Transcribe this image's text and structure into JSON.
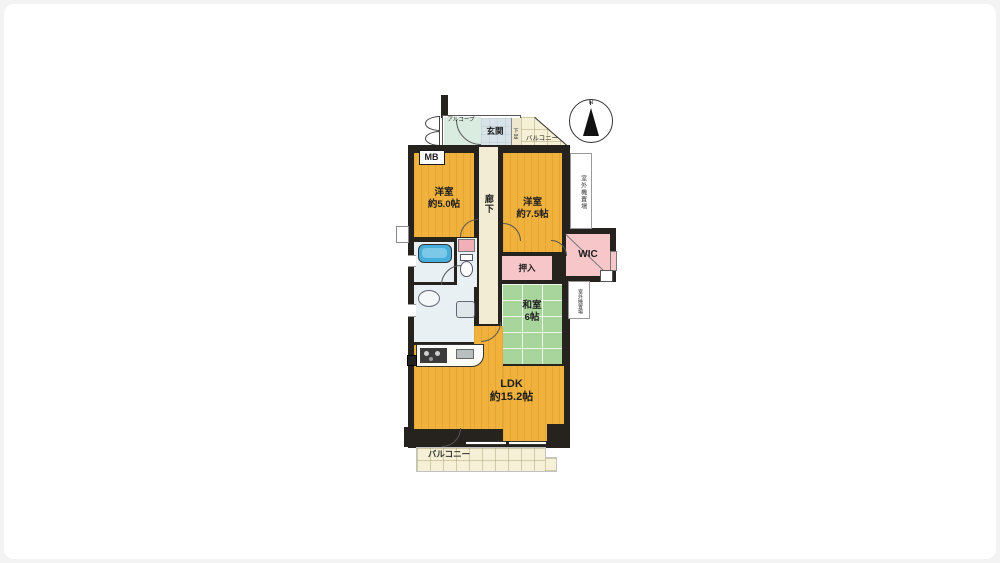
{
  "page": {
    "background": "#f3f3f3",
    "canvas": "#ffffff"
  },
  "compass": {
    "north_label": "N"
  },
  "labels": {
    "alcove": "アルコープ",
    "entrance": "玄関",
    "shoe_box": "下足",
    "balcony_top": "バルコニー",
    "meter_box": "MB",
    "corridor": "廊下",
    "western_room_5": {
      "name": "洋室",
      "size": "約5.0帖"
    },
    "western_room_75": {
      "name": "洋室",
      "size": "約7.5帖"
    },
    "outdoor_unit_upper": "室外機置場",
    "outdoor_unit_lower": "室外機置場",
    "wic": "WIC",
    "oshiire": "押入",
    "japanese_room": {
      "name": "和室",
      "size": "6帖"
    },
    "ldk": {
      "name": "LDK",
      "size": "約15.2帖"
    },
    "balcony_bottom": "バルコニー"
  },
  "colors": {
    "walls": "#26221e",
    "flooring_yellow": "#F0B23C",
    "tatami_green": "#A8D59B",
    "closet_pink": "#F6C6C9",
    "balcony_cream": "#F6F0D6",
    "entrance_blue": "#D7E3E9",
    "alcove_green": "#DAEBDF",
    "bathtub_blue": "#45AEDC"
  }
}
